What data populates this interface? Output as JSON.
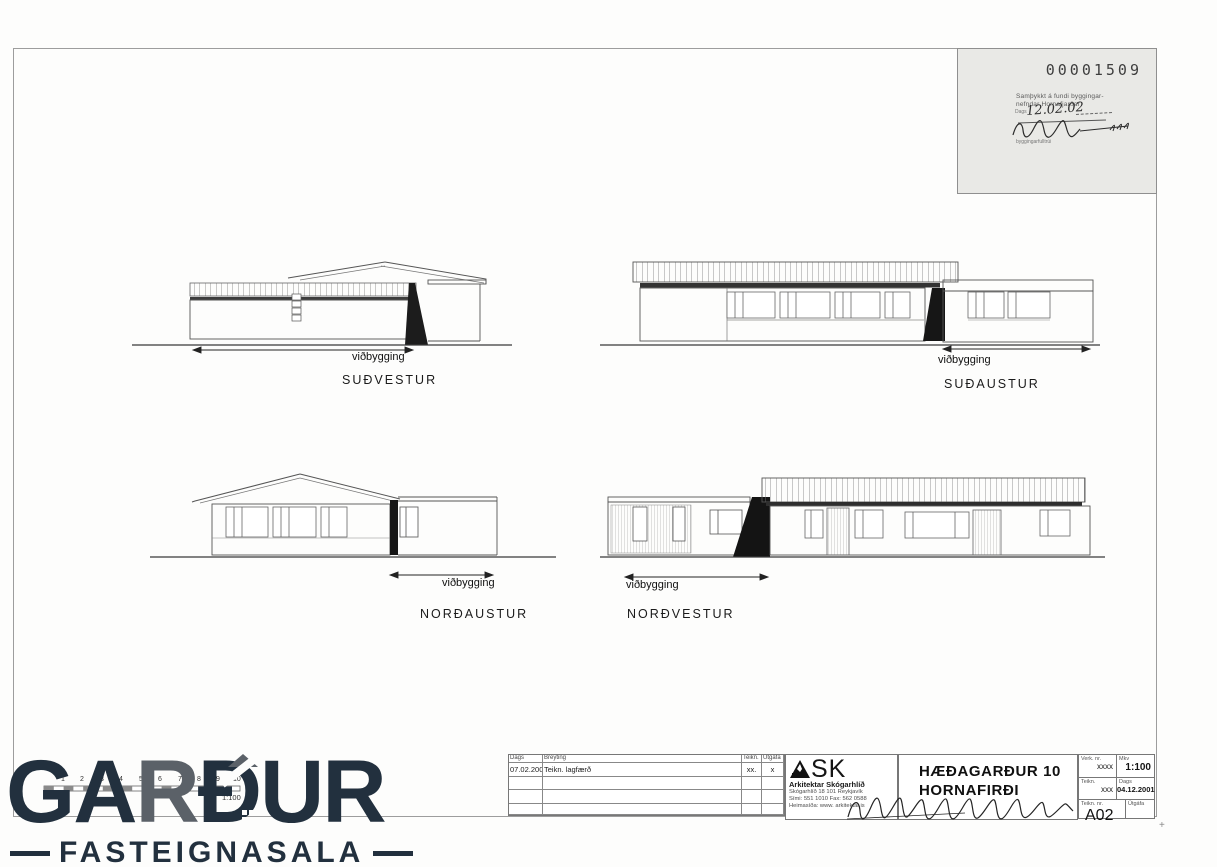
{
  "stamp": {
    "doc_number": "00001509",
    "line1": "Samþykkt á fundi byggingar-",
    "line2": "nefndar Hornafjarðar",
    "date_label": "Dags",
    "date_value": "12.02.02",
    "signature_caption": "byggingarfulltrúi"
  },
  "elevations": [
    {
      "title": "SUÐVESTUR",
      "dim_label": "viðbygging"
    },
    {
      "title": "SUÐAUSTUR",
      "dim_label": "viðbygging"
    },
    {
      "title": "NORÐAUSTUR",
      "dim_label": "viðbygging"
    },
    {
      "title": "NORÐVESTUR",
      "dim_label": "viðbygging"
    }
  ],
  "scale_bar": {
    "numbers": [
      "1",
      "2",
      "3",
      "4",
      "5",
      "6",
      "7",
      "8",
      "9",
      "10"
    ],
    "unit": "M",
    "ratio": "1:100"
  },
  "title_block": {
    "revision_table": {
      "headers": [
        "Dags",
        "Breyting",
        "Teikn.",
        "Útgáfa"
      ],
      "rows": [
        [
          "07.02.2002:",
          "Teikn. lagfærð",
          "xx.",
          "x"
        ]
      ]
    },
    "architect": {
      "logo_text": "SK",
      "name": "Arkitektar Skógarhlíð",
      "address": "Skógarhlíð 18 101 Reykjavík",
      "phone": "Sími: 551 1010  Fax: 562 0588",
      "web": "Heimasíða: www. arkitektar.is"
    },
    "project": {
      "title_line1": "HÆÐAGARÐUR 10",
      "title_line2": "HORNAFIRÐI"
    },
    "info": {
      "verk_nr_label": "Verk. nr.",
      "verk_nr": "xxxx",
      "mkv_label": "Mkv",
      "mkv": "1:100",
      "teikn_label": "Teikn.",
      "teikn": "xxx",
      "dags_label": "Dags",
      "dags": "04.12.2001",
      "teikn_nr_label": "Teikn. nr.",
      "teikn_nr": "A02",
      "utgafa_label": "Útgáfa",
      "utgafa": ""
    }
  },
  "watermark": {
    "brand_ga": "GA",
    "brand_r": "R",
    "brand_dur": "ÐUR",
    "subtitle": "FASTEIGNASALA"
  },
  "marks": {
    "plus": "+"
  }
}
